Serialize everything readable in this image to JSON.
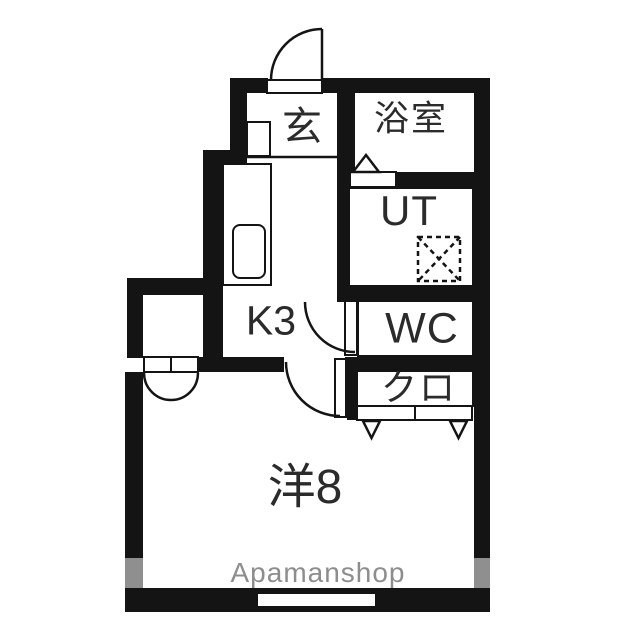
{
  "floorplan": {
    "rooms": {
      "genkan": {
        "label": "玄"
      },
      "bathroom": {
        "label": "浴室"
      },
      "utility": {
        "label": "UT"
      },
      "toilet": {
        "label": "WC"
      },
      "closet": {
        "label": "クロ"
      },
      "kitchen": {
        "label": "K3"
      },
      "western_room": {
        "label": "洋8"
      }
    },
    "watermark": "Apamanshop",
    "symbols": {
      "washer": "washing-machine-placement-icon",
      "doors": [
        "entrance-swing-door",
        "bathroom-folding-door",
        "wc-swing-door",
        "room-swing-door",
        "alcove-double-door",
        "closet-folding-doors"
      ]
    },
    "colors": {
      "wall": "#141414",
      "window_segment": "#8f8f8f",
      "watermark_text": "#8d8d8d",
      "background": "#ffffff"
    }
  }
}
